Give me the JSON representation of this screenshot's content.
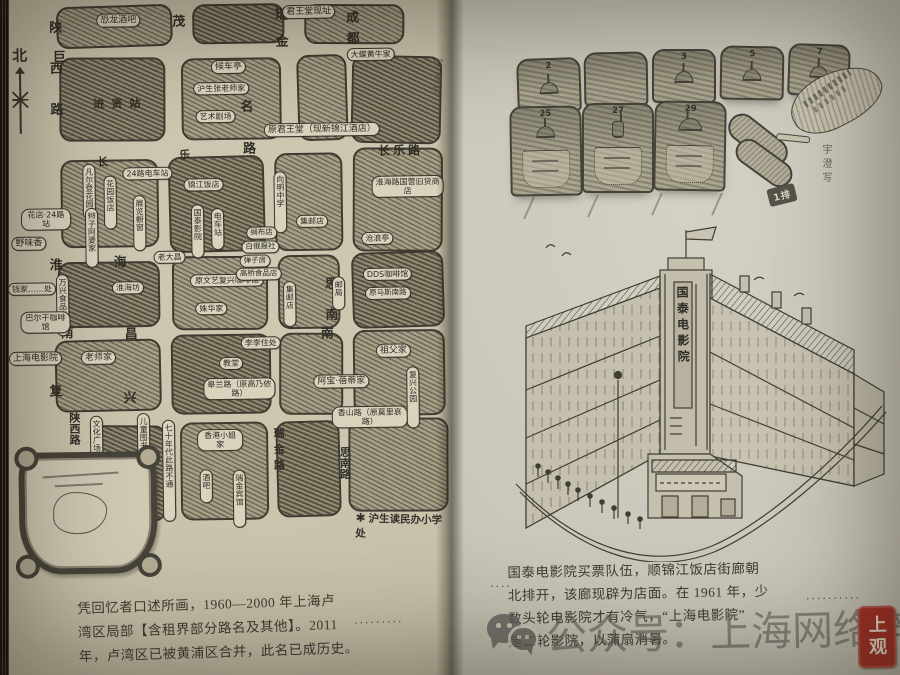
{
  "page_left": {
    "compass_label": "北",
    "signature": "宇澄写",
    "margin_dots": "·········",
    "star_mark": "✱",
    "star_note": "沪生读民办小学处",
    "caption_lines": [
      "凭回忆者口述所画，1960—2000 年上海卢",
      "湾区局部【含租界部分路名及其他】。2011",
      "年，卢湾区已被黄浦区合并，此名已成历史。"
    ],
    "map": {
      "streets": [
        "陕西路",
        "巨",
        "进贤站",
        "茂",
        "名",
        "路",
        "瑞金",
        "成都",
        "长乐路",
        "长",
        "乐",
        "淮",
        "海",
        "南",
        "昌",
        "南",
        "思南",
        "复",
        "兴",
        "陕西路",
        "瑞金路",
        "思南路"
      ],
      "bubbles": [
        "恐龙酒吧",
        "君王堂现址",
        "大蝶黄牛家",
        "候车亭",
        "沪生张老师家",
        "艺术剧场",
        "原君王堂（现新锦江酒店）",
        "24路电车站",
        "凡尔登花园",
        "花园饭店",
        "辫子阿婆家",
        "展览橱窗",
        "锦江饭店",
        "国泰影院",
        "电车站",
        "老大昌",
        "淮海坊",
        "原文艺复兴咖啡馆",
        "姝华家",
        "花店·24路站",
        "野味香",
        "万兴食品店",
        "钱家……处",
        "巴尔干咖啡馆",
        "向明中学",
        "集邮店",
        "集邮店",
        "淮海路国营旧货商店",
        "沧浪亭",
        "DDS咖啡馆",
        "原马斯南路",
        "邮局",
        "绸布店",
        "白俄报社",
        "弹子房",
        "高桥食品店",
        "教堂",
        "李李住处",
        "皋兰路（原高乃依路）",
        "祖父家",
        "阿宝·蓓蒂家",
        "香山路（原莫里哀路）",
        "复兴公园",
        "香港小姐家",
        "酒吧",
        "瑞金宾馆",
        "文化广场",
        "儿童图书馆",
        "七十年代此路不通",
        "上海电影院",
        "老师家",
        "酒吧"
      ]
    }
  },
  "page_right": {
    "seat_row1": [
      "2",
      "",
      "3",
      "5",
      "7"
    ],
    "seat_row2": [
      "25",
      "27",
      "29"
    ],
    "row_plate": "1排",
    "cinema_sign": "国泰电影院",
    "signature": "宇澄写",
    "margin_dots_left": "····",
    "margin_dots_right": "··········",
    "caption_lines": [
      "国泰电影院买票队伍，顺锦江饭店街廊朝",
      "北排开，该廊现辟为店面。在 1961 年，少",
      "数头轮电影院才有冷气，“上海电影院”",
      "是二轮影院，以蒲扇消暑。"
    ]
  },
  "watermark": {
    "wechat_text": "公众号：上海网络辟谣",
    "seal_text": "上观",
    "seal_color": "#a73327"
  }
}
